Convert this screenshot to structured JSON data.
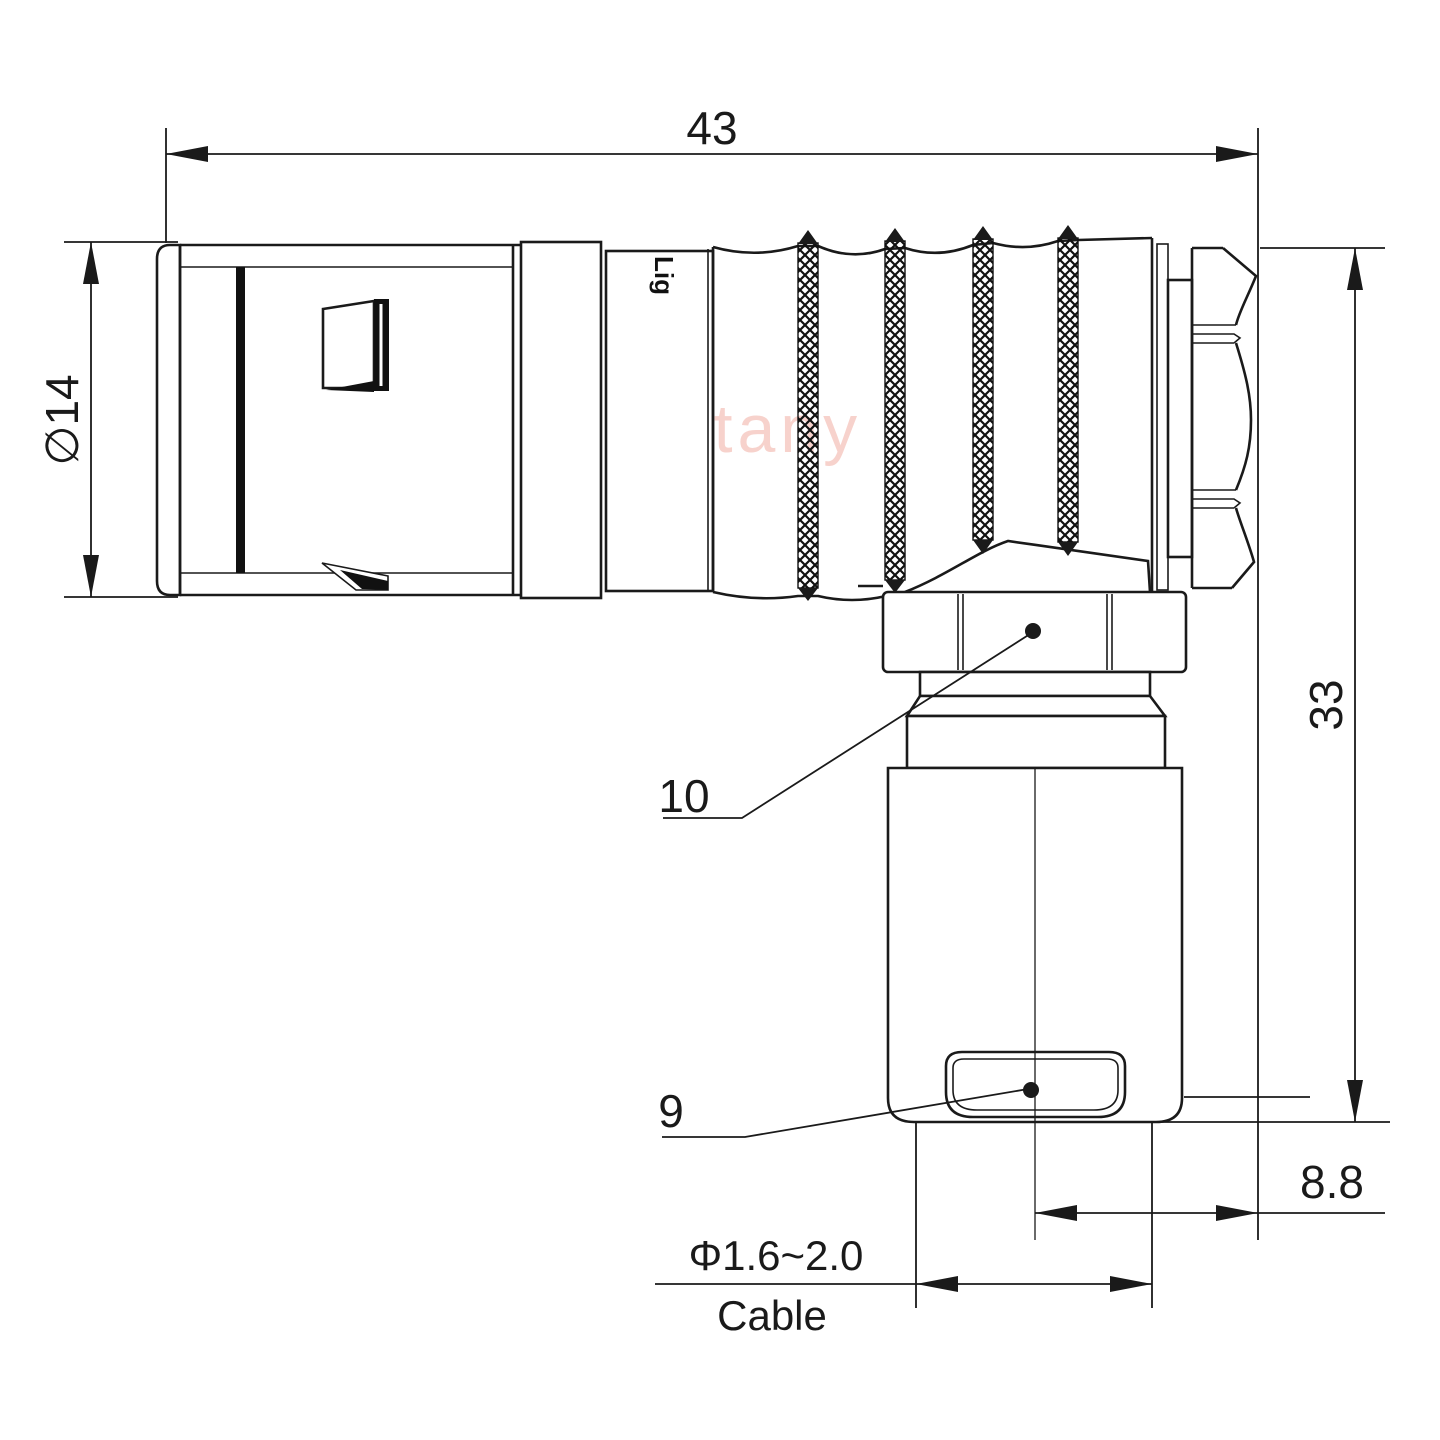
{
  "drawing": {
    "watermark": "Lightany",
    "body_marking": "Lig",
    "labels": {
      "overall_length": "43",
      "front_diameter": "∅14",
      "height": "33",
      "offset": "8.8",
      "cable_diameter": "Φ1.6~2.0",
      "cable": "Cable",
      "callout_10": "10",
      "callout_9": "9"
    },
    "colors": {
      "line": "#1a1a1a",
      "watermark": "#f7d2cc",
      "background": "#ffffff"
    }
  }
}
